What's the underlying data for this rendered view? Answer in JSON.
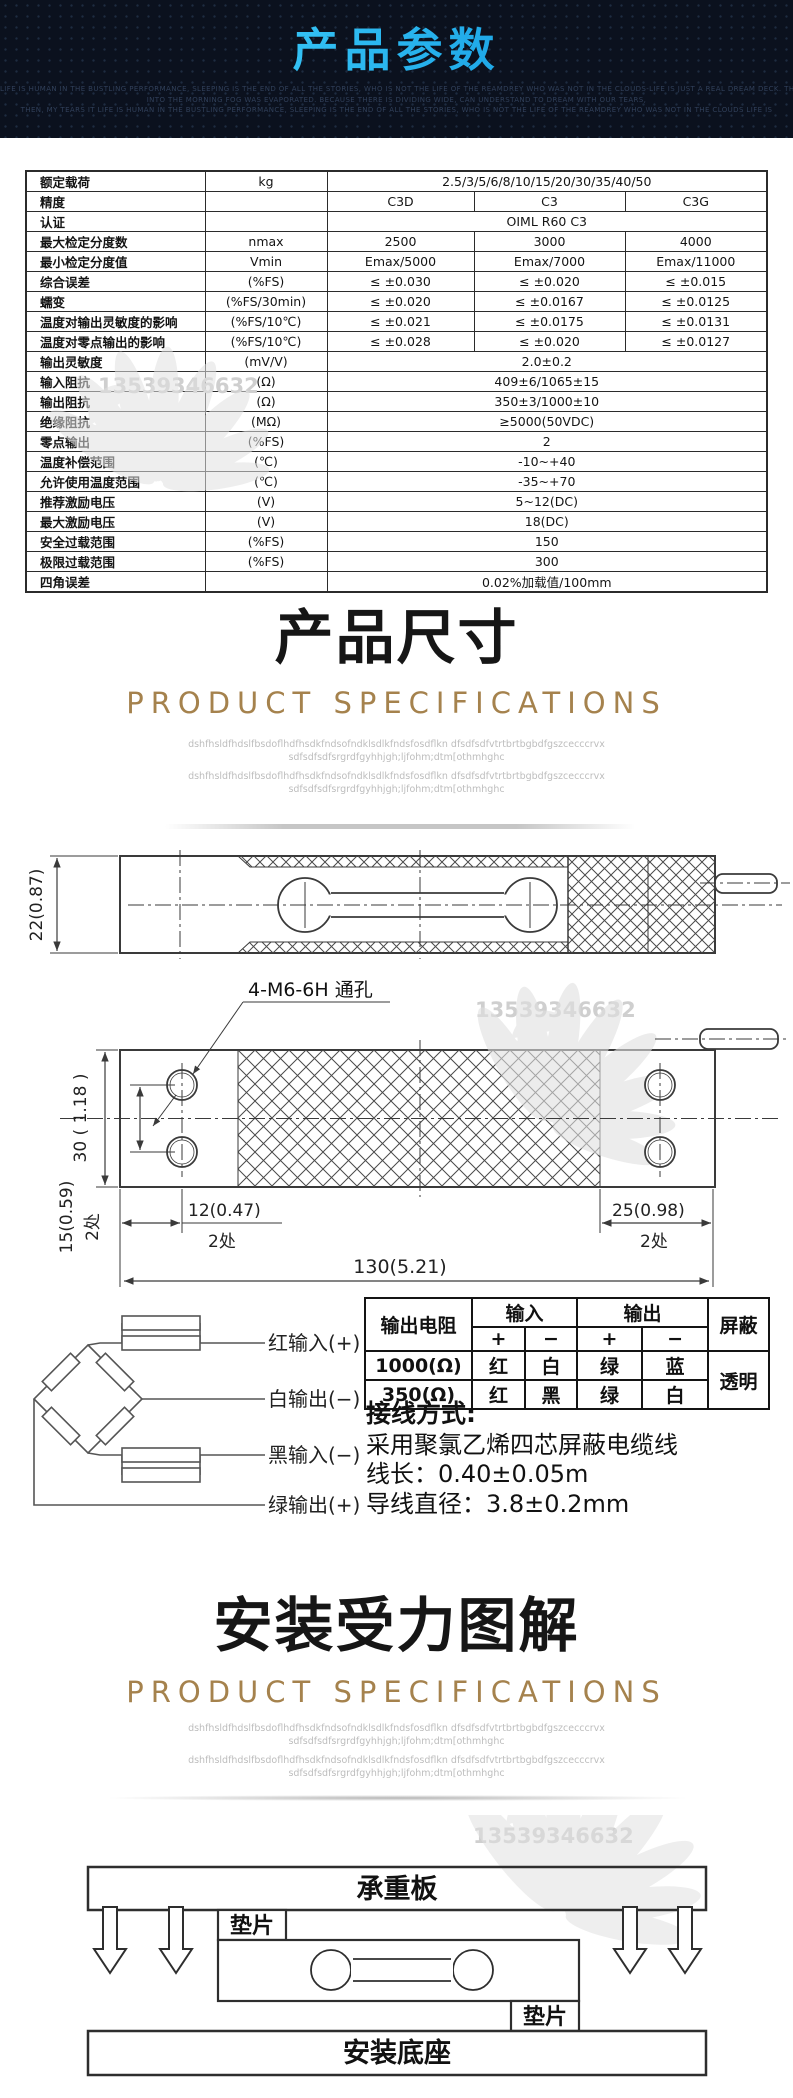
{
  "colors": {
    "accent_cyan_start": "#45d6ff",
    "accent_cyan_end": "#0d93dd",
    "gold": "#a5824d",
    "header_bg": "#0b111e",
    "drawing_line": "#3a3a3a",
    "watermark_gray": "#cfcfcf"
  },
  "header": {
    "title": "产品参数",
    "caption_lines": [
      "LIFE IS HUMAN IN THE BUSTLING PERFORMANCE, SLEEPING IS THE END OF ALL THE STORIES, WHO IS NOT THE LIFE OF THE REAMDREY WHO WAS NOT IN THE CLOUDS-LIFE IS JUST A REAL DREAM DECK. THE NEW SUN, THE CAMENGDE CRY, THOSE SAD",
      "INTO THE MORNING FOG WAS EVAPORATED. BECAUSE THERE IS DIVIDING WIDE, CAN UNDERSTAND TO DREAM WITH OUR TEARS,",
      "THEN, MY TEARS IT LIFE IS HUMAN IN THE BUSTLING PERFORMANCE, SLEEPING IS THE END OF ALL THE STORIES, WHO IS NOT THE LIFE OF THE REAMDREY WHO WAS NOT IN THE CLOUDS LIFE IS"
    ]
  },
  "watermark": {
    "number": "13539346632"
  },
  "spec_table": {
    "rows": [
      {
        "label": "额定载荷",
        "unit": "kg",
        "values": [
          "2.5/3/5/6/8/10/15/20/30/35/40/50"
        ]
      },
      {
        "label": "精度",
        "unit": "",
        "values": [
          "C3D",
          "C3",
          "C3G"
        ]
      },
      {
        "label": "认证",
        "unit": "",
        "values": [
          "OIML R60 C3"
        ]
      },
      {
        "label": "最大检定分度数",
        "unit": "nmax",
        "values": [
          "2500",
          "3000",
          "4000"
        ]
      },
      {
        "label": "最小检定分度值",
        "unit": "Vmin",
        "values": [
          "Emax/5000",
          "Emax/7000",
          "Emax/11000"
        ]
      },
      {
        "label": "综合误差",
        "unit": "(%FS)",
        "values": [
          "≤ ±0.030",
          "≤ ±0.020",
          "≤ ±0.015"
        ]
      },
      {
        "label": "蠕变",
        "unit": "(%FS/30min)",
        "values": [
          "≤ ±0.020",
          "≤ ±0.0167",
          "≤ ±0.0125"
        ]
      },
      {
        "label": "温度对输出灵敏度的影响",
        "unit": "(%FS/10℃)",
        "values": [
          "≤ ±0.021",
          "≤ ±0.0175",
          "≤ ±0.0131"
        ]
      },
      {
        "label": "温度对零点输出的影响",
        "unit": "(%FS/10℃)",
        "values": [
          "≤ ±0.028",
          "≤ ±0.020",
          "≤ ±0.0127"
        ]
      },
      {
        "label": "输出灵敏度",
        "unit": "(mV/V)",
        "values": [
          "2.0±0.2"
        ]
      },
      {
        "label": "输入阻抗",
        "unit": "(Ω)",
        "values": [
          "409±6/1065±15"
        ]
      },
      {
        "label": "输出阻抗",
        "unit": "(Ω)",
        "values": [
          "350±3/1000±10"
        ]
      },
      {
        "label": "绝缘阻抗",
        "unit": "(MΩ)",
        "values": [
          "≥5000(50VDC)"
        ]
      },
      {
        "label": "零点输出",
        "unit": "(%FS)",
        "values": [
          "2"
        ]
      },
      {
        "label": "温度补偿范围",
        "unit": "(℃)",
        "values": [
          "-10~+40"
        ]
      },
      {
        "label": "允许使用温度范围",
        "unit": "(℃)",
        "values": [
          "-35~+70"
        ]
      },
      {
        "label": "推荐激励电压",
        "unit": "(V)",
        "values": [
          "5~12(DC)"
        ]
      },
      {
        "label": "最大激励电压",
        "unit": "(V)",
        "values": [
          "18(DC)"
        ]
      },
      {
        "label": "安全过载范围",
        "unit": "(%FS)",
        "values": [
          "150"
        ]
      },
      {
        "label": "极限过载范围",
        "unit": "(%FS)",
        "values": [
          "300"
        ]
      },
      {
        "label": "四角误差",
        "unit": "",
        "values": [
          "0.02%加载值/100mm"
        ]
      }
    ]
  },
  "dim_section": {
    "title_normal": "产品",
    "title_bold": "尺寸",
    "subtitle": "PRODUCT SPECIFICATIONS",
    "filler1": "dshfhsldfhdslfbsdoflhdfhsdkfndsofndklsdlkfndsfosdflkn dfsdfsdfvtrtbrtbgbdfgszcecccrvx",
    "filler2": "sdfsdfsdfsrgrdfgyhhjgh;ljfohm;dtm[othmhghc"
  },
  "drawing_side": {
    "dim_height": "22(0.87)"
  },
  "drawing_top": {
    "hole_label": "4-M6-6H 通孔",
    "dim_width": "30 ( 1.18 )",
    "dim_hole_offset": "15(0.59)",
    "dim_left": "12(0.47)",
    "dim_total": "130(5.21)",
    "dim_right": "25(0.98)",
    "places": "2处"
  },
  "wiring": {
    "bridge_labels": [
      "红输入(+)",
      "白输出(−)",
      "黑输入(−)",
      "绿输出(+)"
    ],
    "table": {
      "header_resistance": "输出电阻",
      "header_input": "输入",
      "header_output": "输出",
      "header_shield": "屏蔽",
      "plus": "+",
      "minus": "−",
      "rows": [
        {
          "r": "1000(Ω)",
          "c1": "红",
          "c2": "白",
          "c3": "绿",
          "c4": "蓝"
        },
        {
          "r": "350(Ω)",
          "c1": "红",
          "c2": "黑",
          "c3": "绿",
          "c4": "白"
        }
      ],
      "shield": "透明"
    },
    "method_title": "接线方式:",
    "cable_desc": "采用聚氯乙烯四芯屏蔽电缆线",
    "cable_length": "线长：0.40±0.05m",
    "wire_diameter": "导线直径：3.8±0.2mm"
  },
  "install_section": {
    "title_normal": "安装受力",
    "title_bold": "图解",
    "subtitle": "PRODUCT SPECIFICATIONS",
    "filler1": "dshfhsldfhdslfbsdoflhdfhsdkfndsofndklsdlkfndsfosdflkn dfsdfsdfvtrtbrtbgbdfgszcecccrvx",
    "filler2": "sdfsdfsdfsrgrdfgyhhjgh;ljfohm;dtm[othmhghc",
    "top_plate": "承重板",
    "spacer": "垫片",
    "base": "安装底座"
  }
}
